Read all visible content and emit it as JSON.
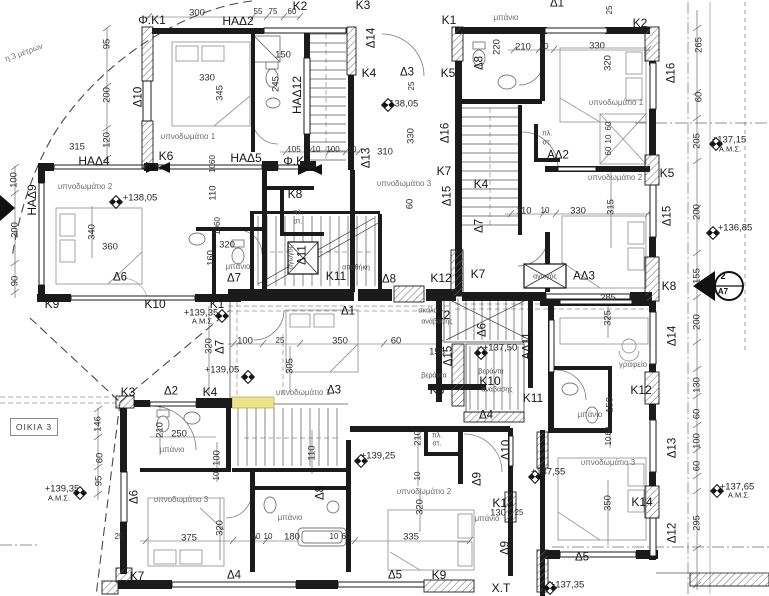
{
  "meta": {
    "house_box": "ΟΙΚΙΑ 3",
    "section_top": "2",
    "section_bottom": "Α7",
    "corridor_label": "Χ.Τ",
    "highlight_color": "#ebe48a"
  },
  "annotations": [
    {
      "t": "η 3 μέτρων",
      "x": 24,
      "y": 53,
      "r": -20,
      "k": "note"
    },
    {
      "t": "Φ.Κ1",
      "x": 152,
      "y": 20,
      "k": "wall"
    },
    {
      "t": "300",
      "x": 197,
      "y": 13,
      "k": "dim"
    },
    {
      "t": "ΗΑΔ2",
      "x": 238,
      "y": 21,
      "k": "win"
    },
    {
      "t": "55",
      "x": 258,
      "y": 12,
      "k": "dims"
    },
    {
      "t": "75",
      "x": 273,
      "y": 12,
      "k": "dims"
    },
    {
      "t": "60",
      "x": 292,
      "y": 12,
      "k": "dims"
    },
    {
      "t": "Κ2",
      "x": 300,
      "y": 6,
      "k": "wall"
    },
    {
      "t": "Κ3",
      "x": 363,
      "y": 5,
      "k": "wall"
    },
    {
      "t": "Κ1",
      "x": 449,
      "y": 20,
      "k": "wall"
    },
    {
      "t": "μπάνιο",
      "x": 506,
      "y": 18,
      "k": "room"
    },
    {
      "t": "Δ1",
      "x": 557,
      "y": 4,
      "k": "door"
    },
    {
      "t": "25",
      "x": 610,
      "y": 10,
      "r": -90,
      "k": "dims"
    },
    {
      "t": "Κ2",
      "x": 640,
      "y": 23,
      "k": "wall"
    },
    {
      "t": "95",
      "x": 107,
      "y": 44,
      "r": -90,
      "k": "dim"
    },
    {
      "t": "200",
      "x": 107,
      "y": 95,
      "r": -90,
      "k": "dim"
    },
    {
      "t": "120",
      "x": 107,
      "y": 140,
      "r": -90,
      "k": "dim"
    },
    {
      "t": "Δ10",
      "x": 139,
      "y": 97,
      "r": -90,
      "k": "door"
    },
    {
      "t": "330",
      "x": 207,
      "y": 78,
      "k": "dim"
    },
    {
      "t": "345",
      "x": 220,
      "y": 93,
      "r": -90,
      "k": "dim"
    },
    {
      "t": "150",
      "x": 283,
      "y": 55,
      "k": "dim"
    },
    {
      "t": "245",
      "x": 276,
      "y": 84,
      "r": -90,
      "k": "dim"
    },
    {
      "t": "ΗΑΔ12",
      "x": 297,
      "y": 95,
      "r": -90,
      "k": "win"
    },
    {
      "t": "Δ14",
      "x": 372,
      "y": 38,
      "r": -90,
      "k": "door"
    },
    {
      "t": "220",
      "x": 497,
      "y": 47,
      "r": -90,
      "k": "dim"
    },
    {
      "t": "Δ8",
      "x": 480,
      "y": 63,
      "r": -90,
      "k": "door"
    },
    {
      "t": "210",
      "x": 523,
      "y": 47,
      "k": "dim"
    },
    {
      "t": "10",
      "x": 544,
      "y": 47,
      "k": "dims"
    },
    {
      "t": "330",
      "x": 597,
      "y": 46,
      "k": "dim"
    },
    {
      "t": "320",
      "x": 608,
      "y": 63,
      "r": -90,
      "k": "dim"
    },
    {
      "t": "Δ16",
      "x": 672,
      "y": 73,
      "r": -90,
      "k": "door"
    },
    {
      "t": "265",
      "x": 699,
      "y": 45,
      "r": -90,
      "k": "dim"
    },
    {
      "t": "υπνοδωμάτιο 1",
      "x": 188,
      "y": 137,
      "k": "room"
    },
    {
      "t": "315",
      "x": 77,
      "y": 147,
      "k": "dim"
    },
    {
      "t": "ΗΑΔ4",
      "x": 94,
      "y": 161,
      "k": "win"
    },
    {
      "t": "Κ6",
      "x": 166,
      "y": 156,
      "k": "wall"
    },
    {
      "t": "ΗΑΔ5",
      "x": 246,
      "y": 158,
      "k": "win"
    },
    {
      "t": "105",
      "x": 294,
      "y": 150,
      "k": "dims"
    },
    {
      "t": "10",
      "x": 316,
      "y": 150,
      "k": "dims"
    },
    {
      "t": "100",
      "x": 333,
      "y": 150,
      "k": "dims"
    },
    {
      "t": "10",
      "x": 352,
      "y": 150,
      "k": "dims"
    },
    {
      "t": "Φ.Κ2",
      "x": 297,
      "y": 161,
      "k": "wall"
    },
    {
      "t": "Κ4",
      "x": 369,
      "y": 73,
      "k": "wall"
    },
    {
      "t": "Δ3",
      "x": 407,
      "y": 73,
      "k": "door"
    },
    {
      "t": "Κ5",
      "x": 448,
      "y": 73,
      "k": "wall"
    },
    {
      "t": "25",
      "x": 412,
      "y": 86,
      "r": -90,
      "k": "dims"
    },
    {
      "t": "+138,05",
      "x": 401,
      "y": 104,
      "k": "level"
    },
    {
      "t": "330",
      "x": 411,
      "y": 136,
      "r": -90,
      "k": "dim"
    },
    {
      "t": "Δ16",
      "x": 446,
      "y": 133,
      "r": -90,
      "k": "door"
    },
    {
      "t": "Δ13",
      "x": 367,
      "y": 158,
      "r": -90,
      "k": "door"
    },
    {
      "t": "310",
      "x": 385,
      "y": 152,
      "k": "dim"
    },
    {
      "t": "υπνοδωμάτιο 1",
      "x": 616,
      "y": 103,
      "k": "room"
    },
    {
      "t": "60",
      "x": 609,
      "y": 126,
      "r": -90,
      "k": "dims"
    },
    {
      "t": "10",
      "x": 609,
      "y": 139,
      "r": -90,
      "k": "dims"
    },
    {
      "t": "60",
      "x": 609,
      "y": 151,
      "r": -90,
      "k": "dims"
    },
    {
      "t": "πλ.",
      "x": 547,
      "y": 134,
      "k": "tiny"
    },
    {
      "t": "στ.",
      "x": 547,
      "y": 143,
      "k": "tiny"
    },
    {
      "t": "ΑΔ2",
      "x": 558,
      "y": 156,
      "k": "door"
    },
    {
      "t": "60",
      "x": 699,
      "y": 97,
      "r": -90,
      "k": "dim"
    },
    {
      "t": "205",
      "x": 697,
      "y": 141,
      "r": -90,
      "k": "dim"
    },
    {
      "t": "+137,15",
      "x": 729,
      "y": 140,
      "k": "level"
    },
    {
      "t": "Α.Μ.Σ.",
      "x": 730,
      "y": 149,
      "k": "levels"
    },
    {
      "t": "Κ5",
      "x": 667,
      "y": 173,
      "k": "wall"
    },
    {
      "t": "υπνοδωμάτιο 2",
      "x": 615,
      "y": 178,
      "k": "room"
    },
    {
      "t": "110",
      "x": 524,
      "y": 211,
      "k": "dim"
    },
    {
      "t": "10",
      "x": 545,
      "y": 211,
      "k": "dims"
    },
    {
      "t": "330",
      "x": 578,
      "y": 211,
      "k": "dim"
    },
    {
      "t": "315",
      "x": 611,
      "y": 207,
      "r": -90,
      "k": "dim"
    },
    {
      "t": "Δ15",
      "x": 668,
      "y": 216,
      "r": -90,
      "k": "door"
    },
    {
      "t": "200",
      "x": 697,
      "y": 212,
      "r": -90,
      "k": "dim"
    },
    {
      "t": "+136,85",
      "x": 735,
      "y": 228,
      "k": "level"
    },
    {
      "t": "155",
      "x": 697,
      "y": 276,
      "r": -90,
      "k": "dim"
    },
    {
      "t": "Κ8",
      "x": 669,
      "y": 286,
      "k": "wall"
    },
    {
      "t": "αγωγός",
      "x": 545,
      "y": 277,
      "k": "tiny"
    },
    {
      "t": "ΑΔ3",
      "x": 584,
      "y": 277,
      "k": "door"
    },
    {
      "t": "285",
      "x": 608,
      "y": 298,
      "k": "dim"
    },
    {
      "t": "Κ7",
      "x": 478,
      "y": 274,
      "k": "wall"
    },
    {
      "t": "Κ4",
      "x": 481,
      "y": 184,
      "k": "wall"
    },
    {
      "t": "Δ7",
      "x": 480,
      "y": 226,
      "r": -90,
      "k": "door"
    },
    {
      "t": "υπνοδωμάτιο 3",
      "x": 404,
      "y": 184,
      "k": "room"
    },
    {
      "t": "Δ15",
      "x": 448,
      "y": 196,
      "r": -90,
      "k": "door"
    },
    {
      "t": "60",
      "x": 410,
      "y": 204,
      "r": -90,
      "k": "dim"
    },
    {
      "t": "Κ7",
      "x": 444,
      "y": 171,
      "k": "wall"
    },
    {
      "t": "100",
      "x": 14,
      "y": 180,
      "r": -90,
      "k": "dim"
    },
    {
      "t": "ΗΑΔ9",
      "x": 32,
      "y": 200,
      "r": -90,
      "k": "win"
    },
    {
      "t": "200",
      "x": 15,
      "y": 230,
      "r": -90,
      "k": "dim"
    },
    {
      "t": "90",
      "x": 15,
      "y": 281,
      "r": -90,
      "k": "dim"
    },
    {
      "t": "υπνοδωμάτιο 2",
      "x": 85,
      "y": 187,
      "k": "room"
    },
    {
      "t": "+138,05",
      "x": 140,
      "y": 198,
      "k": "level"
    },
    {
      "t": "340",
      "x": 92,
      "y": 232,
      "r": -90,
      "k": "dim"
    },
    {
      "t": "360",
      "x": 110,
      "y": 247,
      "k": "dim"
    },
    {
      "t": "Δ6",
      "x": 120,
      "y": 278,
      "k": "door"
    },
    {
      "t": "1060",
      "x": 213,
      "y": 164,
      "r": -90,
      "k": "dims"
    },
    {
      "t": "110",
      "x": 213,
      "y": 193,
      "r": -90,
      "k": "dim"
    },
    {
      "t": "1060",
      "x": 218,
      "y": 226,
      "r": -90,
      "k": "dims"
    },
    {
      "t": "320",
      "x": 227,
      "y": 245,
      "k": "dim"
    },
    {
      "t": "160",
      "x": 211,
      "y": 258,
      "r": -90,
      "k": "dim"
    },
    {
      "t": "μπάνιο",
      "x": 238,
      "y": 267,
      "k": "room"
    },
    {
      "t": "Δ7",
      "x": 234,
      "y": 279,
      "k": "door"
    },
    {
      "t": "Κ8",
      "x": 295,
      "y": 194,
      "k": "wall"
    },
    {
      "t": "πλ.",
      "x": 298,
      "y": 213,
      "k": "tiny"
    },
    {
      "t": "στ.",
      "x": 298,
      "y": 222,
      "k": "tiny"
    },
    {
      "t": "Δ11",
      "x": 303,
      "y": 255,
      "r": -90,
      "k": "door"
    },
    {
      "t": "αγωγός",
      "x": 291,
      "y": 257,
      "r": -90,
      "k": "tiny"
    },
    {
      "t": "Κ11",
      "x": 336,
      "y": 276,
      "k": "wall"
    },
    {
      "t": "αποθήκη",
      "x": 356,
      "y": 268,
      "k": "tiny"
    },
    {
      "t": "Δ8",
      "x": 389,
      "y": 280,
      "k": "door"
    },
    {
      "t": "Κ12",
      "x": 441,
      "y": 278,
      "k": "wall"
    },
    {
      "t": "Κ9",
      "x": 52,
      "y": 304,
      "k": "wall"
    },
    {
      "t": "Κ10",
      "x": 155,
      "y": 304,
      "k": "wall"
    },
    {
      "t": "Κ1",
      "x": 217,
      "y": 304,
      "k": "wall"
    },
    {
      "t": "+139,35",
      "x": 201,
      "y": 313,
      "k": "level"
    },
    {
      "t": "Α.Μ.Σ.",
      "x": 203,
      "y": 321,
      "k": "levels"
    },
    {
      "t": "Δ1",
      "x": 348,
      "y": 312,
      "k": "door"
    },
    {
      "t": "Κ2",
      "x": 443,
      "y": 315,
      "k": "wall"
    },
    {
      "t": "σκάλα",
      "x": 428,
      "y": 311,
      "k": "tiny"
    },
    {
      "t": "ανάβασης",
      "x": 437,
      "y": 322,
      "k": "tiny"
    },
    {
      "t": "320",
      "x": 209,
      "y": 346,
      "r": -90,
      "k": "dim"
    },
    {
      "t": "Δ7",
      "x": 221,
      "y": 347,
      "r": -90,
      "k": "door"
    },
    {
      "t": "100",
      "x": 245,
      "y": 341,
      "k": "dim"
    },
    {
      "t": "25",
      "x": 280,
      "y": 341,
      "k": "dims"
    },
    {
      "t": "350",
      "x": 340,
      "y": 341,
      "k": "dim"
    },
    {
      "t": "60",
      "x": 396,
      "y": 341,
      "k": "dim"
    },
    {
      "t": "305",
      "x": 290,
      "y": 366,
      "r": -90,
      "k": "dim"
    },
    {
      "t": "155",
      "x": 437,
      "y": 352,
      "k": "dim"
    },
    {
      "t": "Δ15",
      "x": 449,
      "y": 356,
      "r": -90,
      "k": "door"
    },
    {
      "t": "+139,05",
      "x": 222,
      "y": 370,
      "k": "level"
    },
    {
      "t": "βεράντα",
      "x": 434,
      "y": 376,
      "k": "tiny"
    },
    {
      "t": "Κ6",
      "x": 437,
      "y": 390,
      "k": "wall"
    },
    {
      "t": "υπνοδωμάτιο 1",
      "x": 303,
      "y": 393,
      "k": "room"
    },
    {
      "t": "Δ3",
      "x": 334,
      "y": 391,
      "k": "door"
    },
    {
      "t": "Δ6",
      "x": 483,
      "y": 330,
      "r": -90,
      "k": "door"
    },
    {
      "t": "+137,50",
      "x": 500,
      "y": 348,
      "k": "level"
    },
    {
      "t": "ΑΔ11",
      "x": 528,
      "y": 346,
      "r": -90,
      "k": "door"
    },
    {
      "t": "βεράντα",
      "x": 491,
      "y": 372,
      "k": "tiny"
    },
    {
      "t": "Κ10",
      "x": 490,
      "y": 381,
      "k": "wall"
    },
    {
      "t": "ανάβασης",
      "x": 497,
      "y": 390,
      "k": "tiny"
    },
    {
      "t": "Κ11",
      "x": 533,
      "y": 398,
      "k": "wall"
    },
    {
      "t": "Δ4",
      "x": 486,
      "y": 416,
      "k": "door"
    },
    {
      "t": "325",
      "x": 608,
      "y": 318,
      "r": -90,
      "k": "dim"
    },
    {
      "t": "Δ14",
      "x": 673,
      "y": 336,
      "r": -90,
      "k": "door"
    },
    {
      "t": "200",
      "x": 697,
      "y": 322,
      "r": -90,
      "k": "dim"
    },
    {
      "t": "γραφείο",
      "x": 633,
      "y": 365,
      "k": "room"
    },
    {
      "t": "Κ12",
      "x": 641,
      "y": 390,
      "k": "wall"
    },
    {
      "t": "150",
      "x": 610,
      "y": 405,
      "r": -90,
      "k": "dim"
    },
    {
      "t": "μπάνιο",
      "x": 590,
      "y": 415,
      "k": "room"
    },
    {
      "t": "130",
      "x": 697,
      "y": 385,
      "r": -90,
      "k": "dim"
    },
    {
      "t": "60",
      "x": 609,
      "y": 431,
      "r": -90,
      "k": "dims"
    },
    {
      "t": "10",
      "x": 609,
      "y": 441,
      "r": -90,
      "k": "dims"
    },
    {
      "t": "60",
      "x": 697,
      "y": 414,
      "r": -90,
      "k": "dim"
    },
    {
      "t": "100",
      "x": 697,
      "y": 441,
      "r": -90,
      "k": "dim"
    },
    {
      "t": "Δ13",
      "x": 673,
      "y": 448,
      "r": -90,
      "k": "door"
    },
    {
      "t": "υπνοδωμάτιο 3",
      "x": 608,
      "y": 463,
      "k": "room"
    },
    {
      "t": "+137,55",
      "x": 548,
      "y": 472,
      "k": "level"
    },
    {
      "t": "60",
      "x": 697,
      "y": 466,
      "r": -90,
      "k": "dim"
    },
    {
      "t": "350",
      "x": 608,
      "y": 503,
      "r": -90,
      "k": "dim"
    },
    {
      "t": "Κ14",
      "x": 642,
      "y": 502,
      "k": "wall"
    },
    {
      "t": "295",
      "x": 697,
      "y": 523,
      "r": -90,
      "k": "dim"
    },
    {
      "t": "+137,65",
      "x": 737,
      "y": 487,
      "k": "level"
    },
    {
      "t": "Α.Μ.Σ.",
      "x": 739,
      "y": 495,
      "k": "levels"
    },
    {
      "t": "Δ12",
      "x": 673,
      "y": 533,
      "r": -90,
      "k": "door"
    },
    {
      "t": "Δ5",
      "x": 582,
      "y": 558,
      "k": "door"
    },
    {
      "t": "+137,35",
      "x": 567,
      "y": 585,
      "k": "level"
    },
    {
      "t": "Κ3",
      "x": 128,
      "y": 392,
      "k": "wall"
    },
    {
      "t": "Δ2",
      "x": 171,
      "y": 392,
      "k": "door"
    },
    {
      "t": "Κ4",
      "x": 210,
      "y": 392,
      "k": "wall"
    },
    {
      "t": "146",
      "x": 98,
      "y": 424,
      "r": -90,
      "k": "dim"
    },
    {
      "t": "60",
      "x": 100,
      "y": 458,
      "r": -90,
      "k": "dim"
    },
    {
      "t": "95",
      "x": 99,
      "y": 481,
      "r": -90,
      "k": "dim"
    },
    {
      "t": "210",
      "x": 160,
      "y": 430,
      "r": -90,
      "k": "dim"
    },
    {
      "t": "250",
      "x": 179,
      "y": 434,
      "k": "dim"
    },
    {
      "t": "μπάνιο",
      "x": 172,
      "y": 450,
      "k": "room"
    },
    {
      "t": "100",
      "x": 217,
      "y": 458,
      "r": -90,
      "k": "dim"
    },
    {
      "t": "10",
      "x": 217,
      "y": 476,
      "r": -90,
      "k": "dims"
    },
    {
      "t": "Δ6",
      "x": 135,
      "y": 497,
      "r": -90,
      "k": "door"
    },
    {
      "t": "υπνοδωμάτιο 3",
      "x": 181,
      "y": 500,
      "k": "room"
    },
    {
      "t": "375",
      "x": 189,
      "y": 538,
      "k": "dim"
    },
    {
      "t": "320",
      "x": 220,
      "y": 528,
      "r": -90,
      "k": "dim"
    },
    {
      "t": "25",
      "x": 119,
      "y": 537,
      "k": "dims"
    },
    {
      "t": "+139,35",
      "x": 62,
      "y": 489,
      "k": "level"
    },
    {
      "t": "Α.Μ.Σ.",
      "x": 59,
      "y": 498,
      "k": "levels"
    },
    {
      "t": "Κ7",
      "x": 137,
      "y": 576,
      "k": "wall"
    },
    {
      "t": "Δ4",
      "x": 234,
      "y": 576,
      "k": "door"
    },
    {
      "t": "110",
      "x": 312,
      "y": 453,
      "r": -90,
      "k": "dim"
    },
    {
      "t": "Δ8",
      "x": 321,
      "y": 493,
      "r": -90,
      "k": "door"
    },
    {
      "t": "μπάνιο",
      "x": 290,
      "y": 518,
      "k": "room"
    },
    {
      "t": "60",
      "x": 256,
      "y": 537,
      "k": "dims"
    },
    {
      "t": "10",
      "x": 268,
      "y": 537,
      "k": "dims"
    },
    {
      "t": "180",
      "x": 292,
      "y": 537,
      "k": "dim"
    },
    {
      "t": "10",
      "x": 334,
      "y": 537,
      "k": "dims"
    },
    {
      "t": "60",
      "x": 346,
      "y": 537,
      "k": "dims"
    },
    {
      "t": "+139,25",
      "x": 378,
      "y": 456,
      "k": "level"
    },
    {
      "t": "210",
      "x": 418,
      "y": 438,
      "r": -90,
      "k": "dim"
    },
    {
      "t": "10",
      "x": 418,
      "y": 476,
      "r": -90,
      "k": "dims"
    },
    {
      "t": "πλ.",
      "x": 437,
      "y": 436,
      "k": "tiny"
    },
    {
      "t": "στ.",
      "x": 437,
      "y": 444,
      "k": "tiny"
    },
    {
      "t": "υπνοδωμάτιο 2",
      "x": 424,
      "y": 492,
      "k": "room"
    },
    {
      "t": "320",
      "x": 420,
      "y": 507,
      "r": -90,
      "k": "dim"
    },
    {
      "t": "335",
      "x": 411,
      "y": 537,
      "k": "dim"
    },
    {
      "t": "Δ5",
      "x": 395,
      "y": 576,
      "k": "door"
    },
    {
      "t": "Κ9",
      "x": 439,
      "y": 575,
      "k": "wall"
    },
    {
      "t": "μπάνιο",
      "x": 487,
      "y": 519,
      "k": "room"
    },
    {
      "t": "Δ9",
      "x": 478,
      "y": 479,
      "r": -90,
      "k": "door"
    },
    {
      "t": "Δ10",
      "x": 507,
      "y": 450,
      "r": -90,
      "k": "door"
    },
    {
      "t": "Κ13",
      "x": 503,
      "y": 503,
      "k": "wall"
    },
    {
      "t": "130",
      "x": 498,
      "y": 513,
      "k": "dim"
    },
    {
      "t": "25",
      "x": 519,
      "y": 513,
      "k": "dims"
    },
    {
      "t": "Δ9",
      "x": 506,
      "y": 548,
      "r": -90,
      "k": "door"
    },
    {
      "t": "Χ.Τ",
      "x": 501,
      "y": 588,
      "k": "wall"
    }
  ],
  "level_markers": [
    {
      "x": 388,
      "y": 105
    },
    {
      "x": 116,
      "y": 202
    },
    {
      "x": 222,
      "y": 316
    },
    {
      "x": 80,
      "y": 493
    },
    {
      "x": 248,
      "y": 377
    },
    {
      "x": 361,
      "y": 461
    },
    {
      "x": 481,
      "y": 353
    },
    {
      "x": 535,
      "y": 477
    },
    {
      "x": 716,
      "y": 144
    },
    {
      "x": 713,
      "y": 233
    },
    {
      "x": 717,
      "y": 491
    },
    {
      "x": 550,
      "y": 588
    }
  ]
}
